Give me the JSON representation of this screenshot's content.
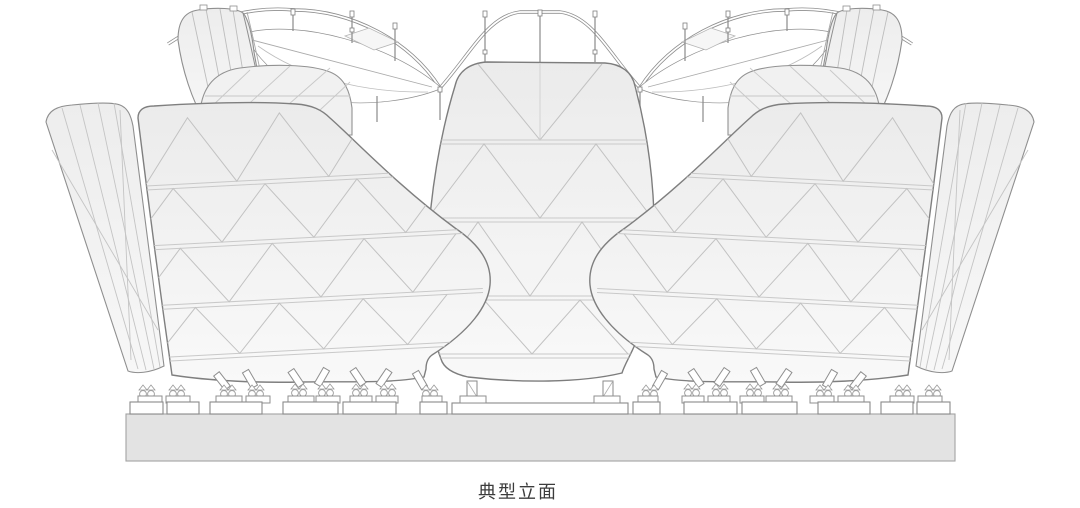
{
  "page": {
    "background_color": "#ffffff"
  },
  "figure": {
    "type": "architectural-line-drawing",
    "view": "typical-elevation",
    "description": "Symmetric elevation of a lotus / petal shaped pavilion: triangulated facade petals, wavy canopy ribbon with hanger posts, eye-shaped canopy openings, bearing footings on pedestals and a grey podium slab",
    "colors": {
      "outline": "#858585",
      "grid_line": "#c9c9c9",
      "petal_fill_top": "#ebebeb",
      "petal_fill_bottom": "#f9f9f9",
      "podium_fill": "#e3e3e3",
      "podium_stroke": "#a3a3a3",
      "caption_color": "#3c3c3c",
      "background": "#ffffff"
    }
  },
  "caption": {
    "text": "典型立面"
  }
}
